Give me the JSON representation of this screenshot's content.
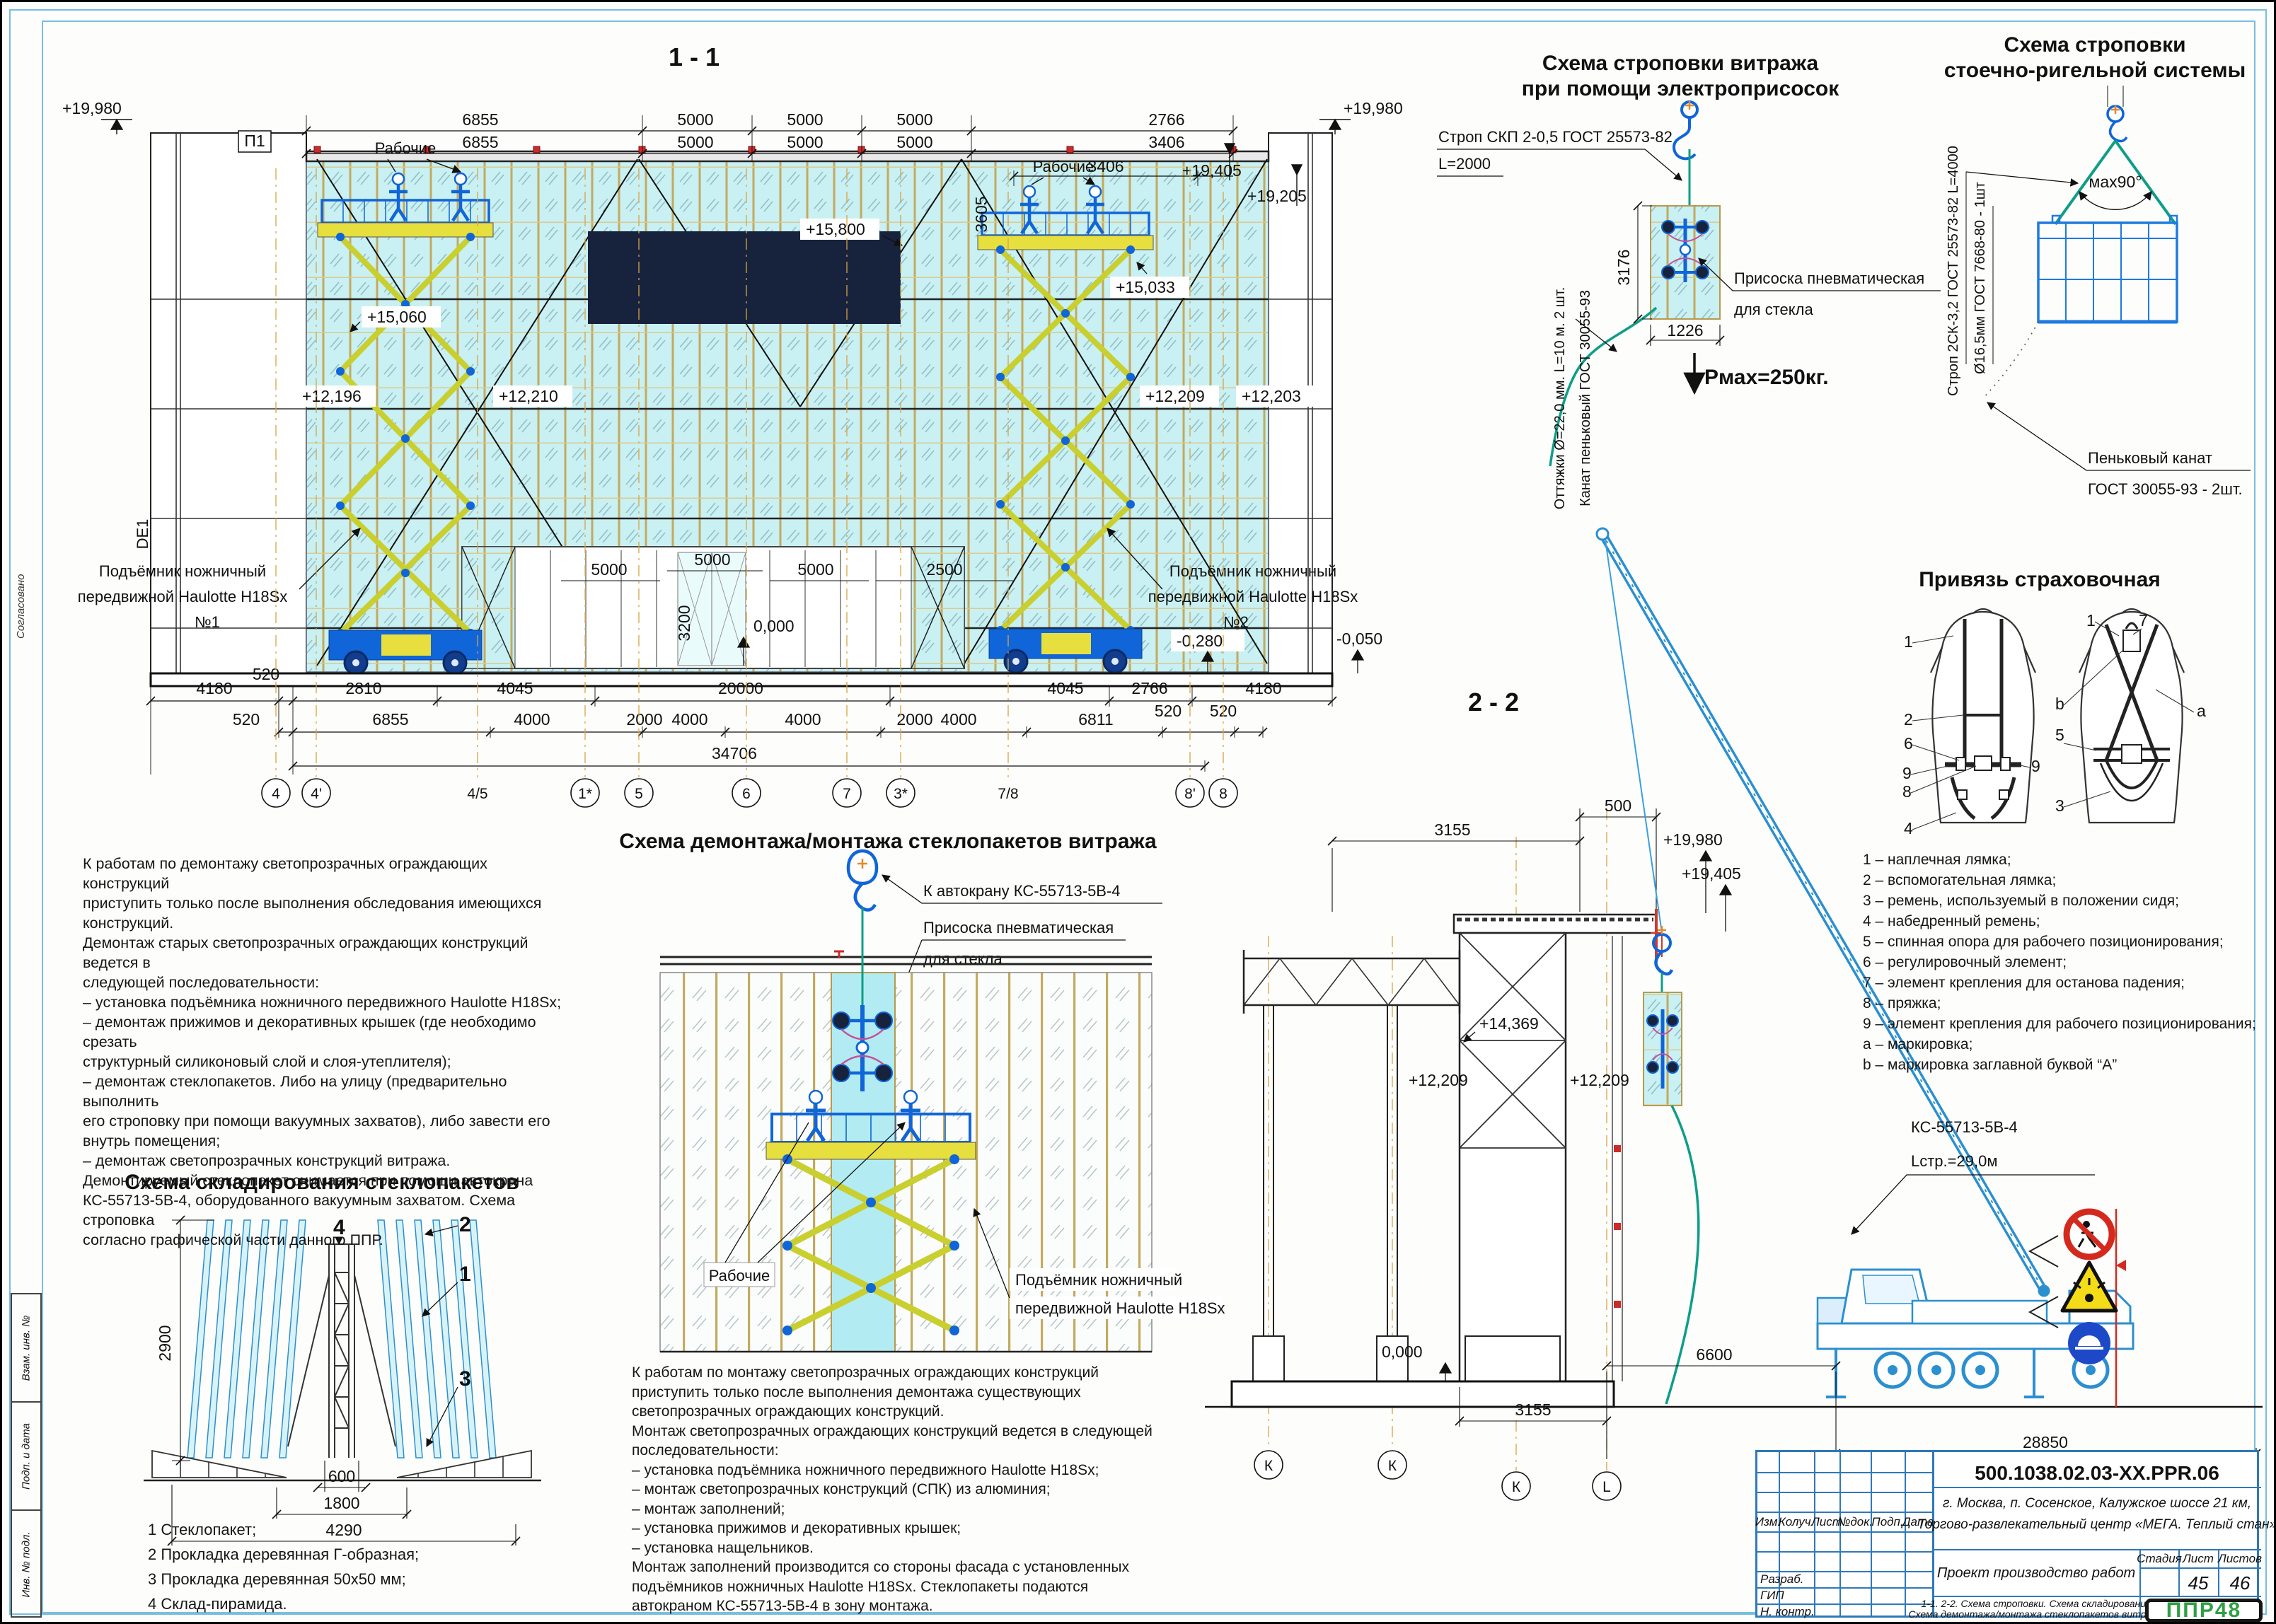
{
  "sheet_border": {
    "left_stamp": [
      "Взам. инв. №",
      "Подп. и дата",
      "Инв. № подл."
    ],
    "soglas": "Согласовано"
  },
  "facade": {
    "title": "1 - 1",
    "axis_box": "П1",
    "axis_left": "DE1",
    "workers": "Рабочие",
    "lift_line1": "Подъёмник ножничный",
    "lift_line2": "передвижной Haulotte H18Sx",
    "lift1_no": "№1",
    "lift2_no": "№2",
    "elev_19980": "+19,980",
    "elev_19405": "+19,405",
    "elev_19205": "+19,205",
    "elev_15800": "+15,800",
    "elev_15060": "+15,060",
    "elev_15033": "+15,033",
    "elev_12196": "+12,196",
    "elev_12210": "+12,210",
    "elev_12209": "+12,209",
    "elev_12203": "+12,203",
    "elev_zero": "0,000",
    "elev_m0280": "-0,280",
    "elev_m0050": "-0,050",
    "dim_6855": "6855",
    "dim_5000": "5000",
    "dim_2766": "2766",
    "dim_3406": "3406",
    "dim_3605": "3605",
    "dim_3200": "3200",
    "dim_2500": "2500",
    "dim_4180": "4180",
    "dim_520": "520",
    "dim_2810": "2810",
    "dim_4045": "4045",
    "dim_20000": "20000",
    "dim_4000": "4000",
    "dim_2000": "2000",
    "dim_6811": "6811",
    "dim_34706": "34706",
    "grid": [
      "4",
      "4'",
      "4/5",
      "1*",
      "5",
      "6",
      "7",
      "3*",
      "7/8",
      "8'",
      "8"
    ]
  },
  "sling1": {
    "title1": "Схема строповки витража",
    "title2": "при помощи электроприсосок",
    "sling_label1": "Строп СКП 2-0,5 ГОСТ 25573-82",
    "sling_label2": "L=2000",
    "suction1": "Присоска пневматическая",
    "suction2": "для стекла",
    "rot1": "Оттяжки Ø=22,0 мм. L=10 м. 2 шт.",
    "rot2": "Канат пеньковый ГОСТ 30055-93",
    "dim_h": "3176",
    "dim_w": "1226",
    "pmax": "Рмах=250кг."
  },
  "sling2": {
    "title1": "Схема строповки",
    "title2": "стоечно-ригельной системы",
    "rot1": "Строп 2СК-3,2 ГОСТ 25573-82  L=4000",
    "rot2": "Ø16,5мм ГОСТ 7668-80  - 1шт",
    "angle": "мах90°",
    "rope1": "Пеньковый канат",
    "rope2": "ГОСТ 30055-93 - 2шт."
  },
  "harness": {
    "title": "Привязь страховочная",
    "callouts": {
      "c1": "1",
      "c2": "2",
      "c3": "3",
      "c4": "4",
      "c5": "5",
      "c6": "6",
      "c7": "7",
      "c8": "8",
      "c9": "9",
      "ca": "a",
      "cb": "b"
    },
    "legend": [
      "1 – наплечная лямка;",
      "2 – вспомогательная лямка;",
      "3 – ремень, используемый в положении сидя;",
      "4 – набедренный ремень;",
      "5 – спинная опора для рабочего позиционирования;",
      "6 – регулировочный элемент;",
      "7 – элемент крепления для останова падения;",
      "8 – пряжка;",
      "9 – элемент крепления для рабочего позиционирования;",
      "a – маркировка;",
      "b – маркировка заглавной буквой “А”"
    ]
  },
  "demo_scheme": {
    "title": "Схема демонтажа/монтажа стеклопакетов витража",
    "to_crane": "К автокрану КС-55713-5В-4",
    "suction1": "Присоска пневматическая",
    "suction2": "для стекла",
    "workers": "Рабочие",
    "lift1": "Подъёмник ножничный",
    "lift2": "передвижной Haulotte H18Sx"
  },
  "storage": {
    "title": "Схема складирования стеклопакетов",
    "dim_2900": "2900",
    "dim_600": "600",
    "dim_1800": "1800",
    "dim_4290": "4290",
    "callout1": "1",
    "callout2": "2",
    "callout3": "3",
    "callout4": "4",
    "legend": [
      "1 Стеклопакет;",
      "2 Прокладка деревянная Г-образная;",
      "3 Прокладка деревянная 50х50 мм;",
      "4 Склад-пирамида."
    ]
  },
  "section22": {
    "title": "2 - 2",
    "dim_3155": "3155",
    "dim_500": "500",
    "dim_6600": "6600",
    "dim_28850": "28850",
    "elev_19980": "+19,980",
    "elev_19405": "+19,405",
    "elev_14369": "+14,369",
    "elev_12209": "+12,209",
    "elev_zero": "0,000",
    "crane1": "КС-55713-5В-4",
    "crane2": "Lстр.=29,0м",
    "grid_k": "К",
    "grid_l": "L"
  },
  "notes": {
    "demontage": "К работам по демонтажу светопрозрачных ограждающих конструкций\nприступить только после выполнения обследования имеющихся\nконструкций.\nДемонтаж старых светопрозрачных ограждающих конструкций ведется в\nследующей последовательности:\n– установка подъёмника ножничного передвижного Haulotte H18Sx;\n– демонтаж прижимов и декоративных крышек (где необходимо срезать\nструктурный силиконовый слой и слоя-утеплителя);\n– демонтаж стеклопакетов. Либо на улицу (предварительно выполнить\nего строповку при помощи вакуумных захватов), либо завести его\nвнутрь помещения;\n– демонтаж светопрозрачных конструкций витража.\nДемонтируемый стеклопакет снимается при помощи автокрана\nКС-55713-5В-4, оборудованного вакуумным захватом. Схема строповка\nсогласно графической части данного ППР.",
    "montage": "К работам по монтажу светопрозрачных ограждающих конструкций\nприступить только после выполнения демонтажа существующих\nсветопрозрачных ограждающих конструкций.\nМонтаж светопрозрачных ограждающих конструкций ведется в следующей\nпоследовательности:\n– установка подъёмника ножничного передвижного Haulotte H18Sx;\n– монтаж светопрозрачных конструкций (СПК) из алюминия;\n– монтаж заполнений;\n– установка прижимов и декоративных крышек;\n– установка нащельников.\nМонтаж заполнений производится со стороны фасада с установленных\nподъёмников ножничных Haulotte H18Sx. Стеклопакеты подаются\nавтокраном КС-55713-5В-4 в зону монтажа."
  },
  "titleblock": {
    "doc_number": "500.1038.02.03-XX.PPR.06",
    "location1": "г. Москва, п. Сосенское, Калужское шоссе 21 км,",
    "location2": "Торгово-развлекательный центр «МЕГА. Теплый стан»",
    "project": "Проект производство работ",
    "stage_label": "Стадия",
    "sheet_label": "Лист",
    "sheets_label": "Листов",
    "sheet_no": "45",
    "sheets_total": "46",
    "title1": "1-1. 2-2. Схема строповки. Схема складирования",
    "title2": "Схема демонтажа/монтажа стеклопакетов витража",
    "cols": [
      "Изм.",
      "Колуч.",
      "Лист",
      "№док.",
      "Подп.",
      "Дата"
    ],
    "roles": [
      "Разраб.",
      "ГИП",
      "Н. контр."
    ],
    "logo": "ППР48"
  }
}
